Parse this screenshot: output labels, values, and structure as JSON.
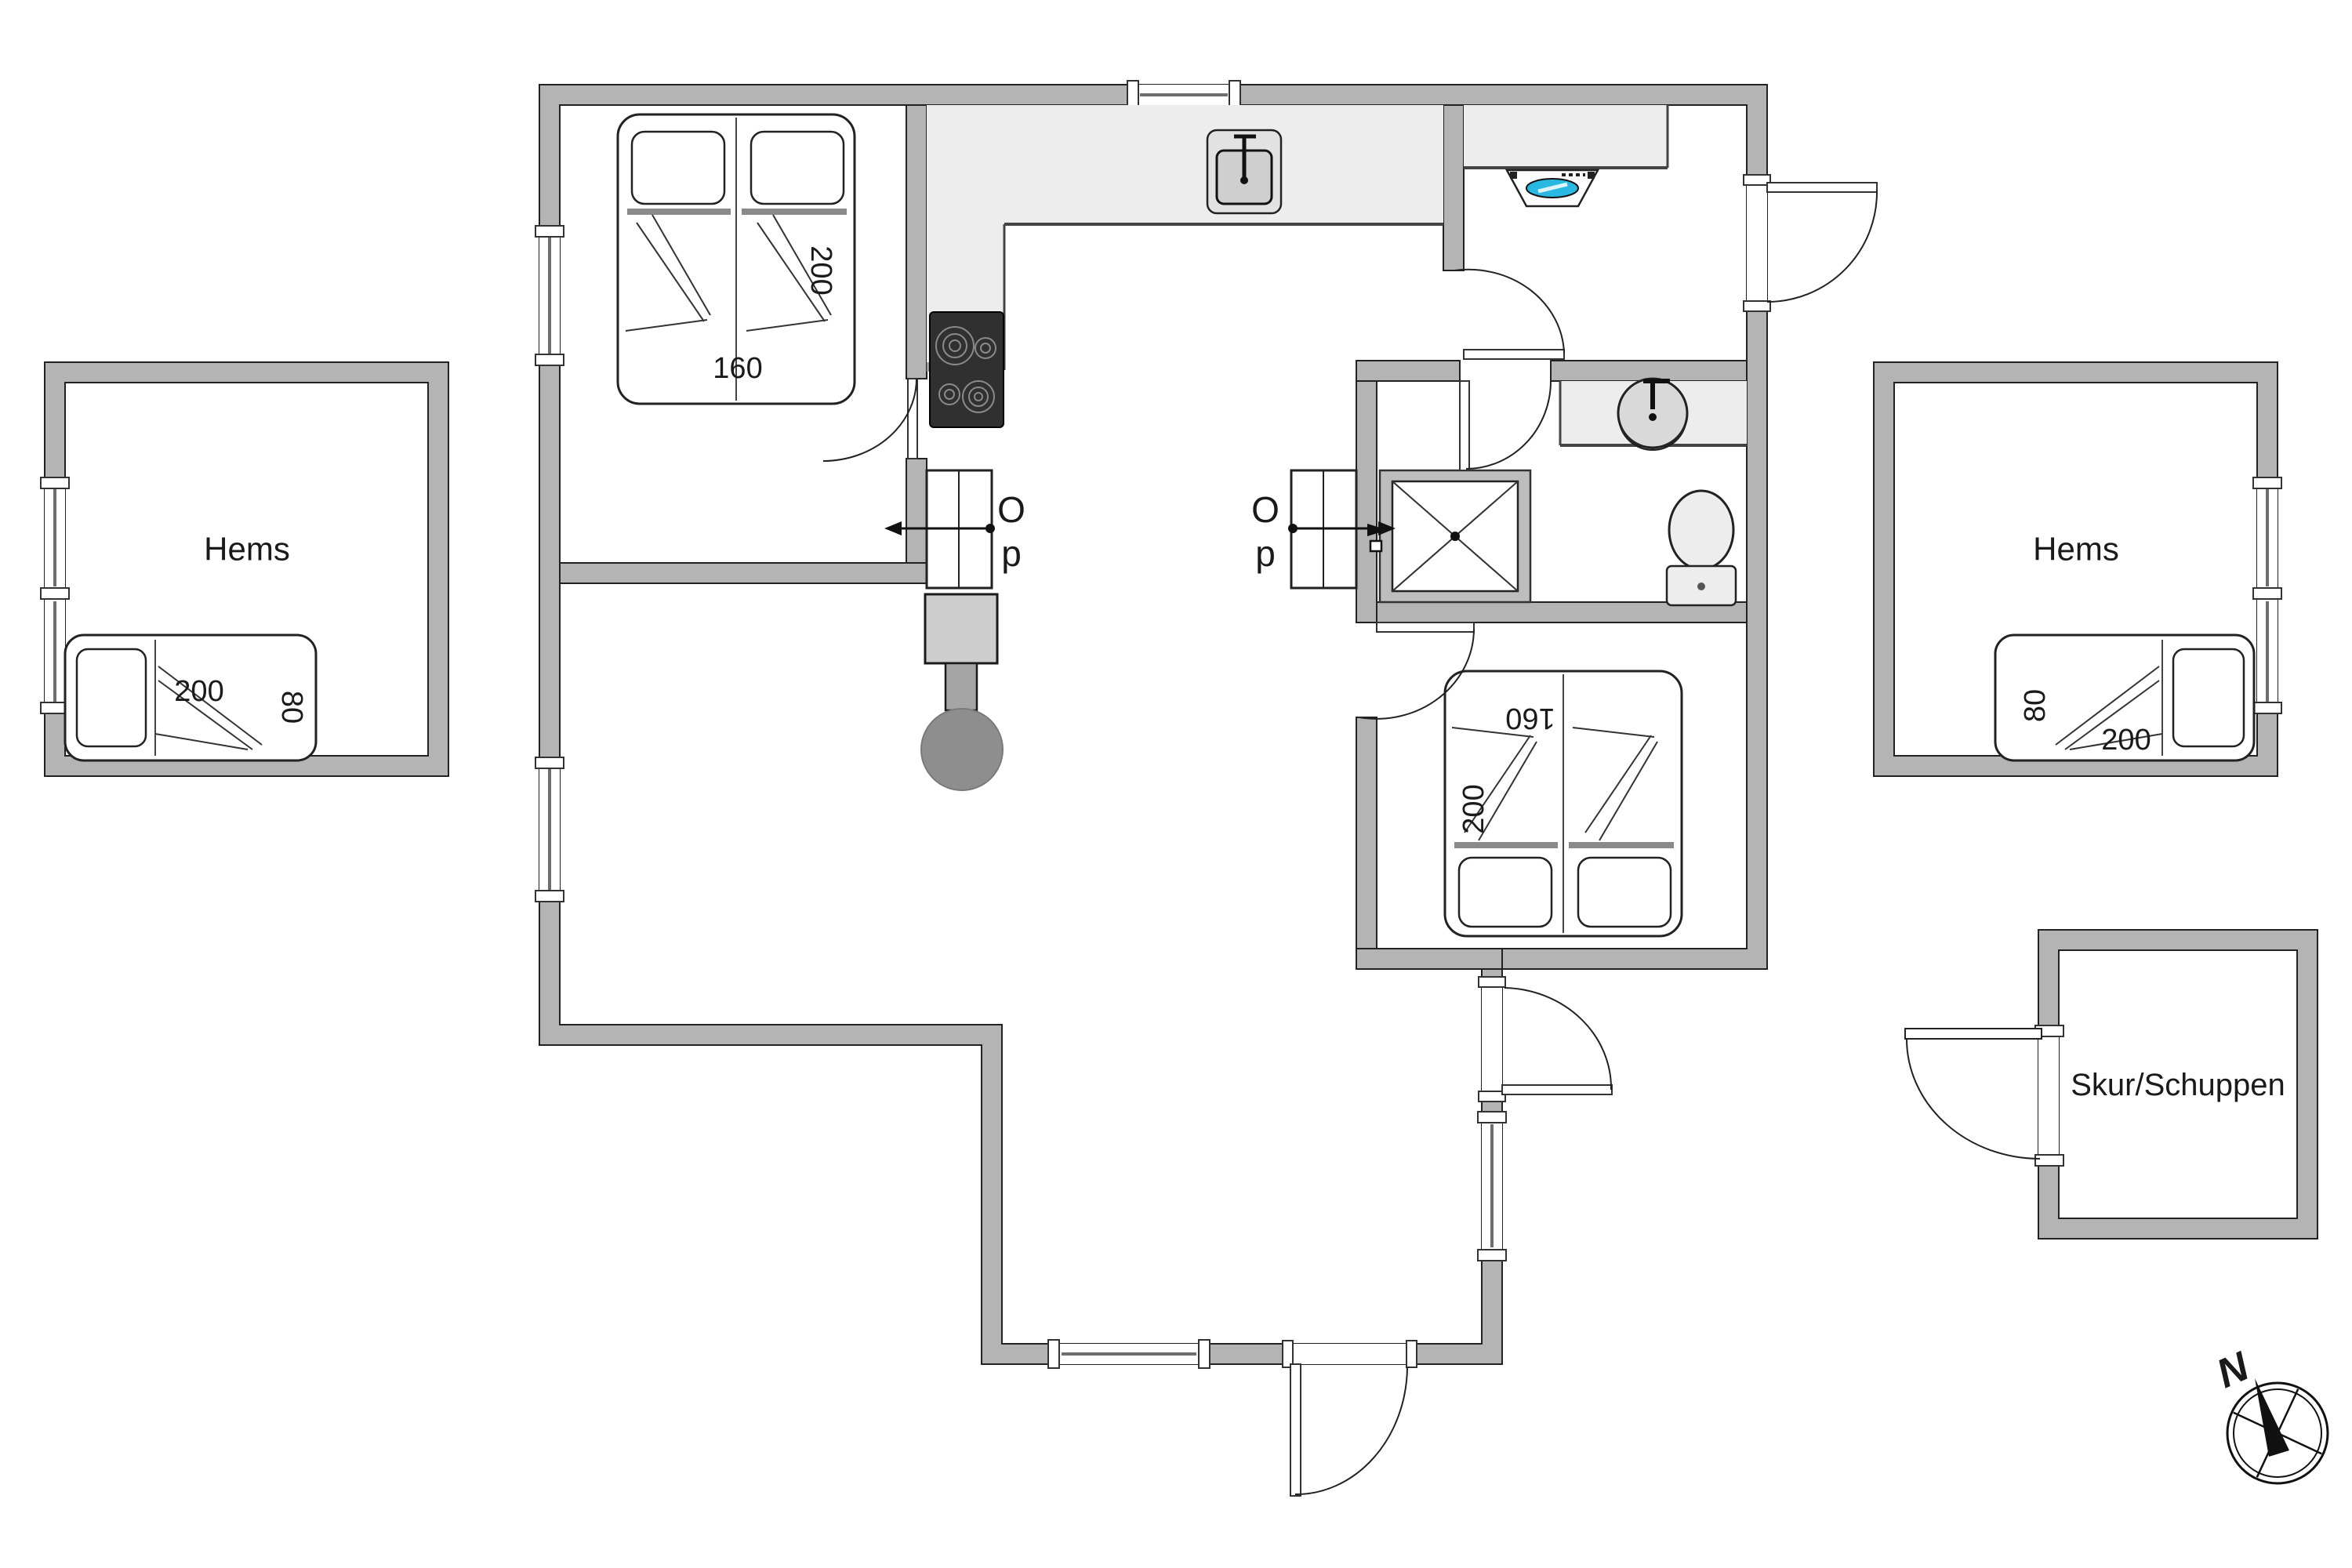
{
  "labels": {
    "hems_left": "Hems",
    "hems_right": "Hems",
    "shed": "Skur/Schuppen",
    "compass_north": "N",
    "stair_left_up_line1": "O",
    "stair_left_up_line2": "p",
    "stair_right_up_line1": "O",
    "stair_right_up_line2": "p"
  },
  "dimensions": {
    "bedroom1_bed_length": "200",
    "bedroom1_bed_width": "160",
    "bedroom2_bed_length": "200",
    "bedroom2_bed_width": "160",
    "hems_left_bed_length": "200",
    "hems_left_bed_width": "80",
    "hems_right_bed_length": "200",
    "hems_right_bed_width": "80"
  },
  "icons": {
    "kitchen_sink": "sink-icon",
    "stove": "cooktop-icon",
    "extractor": "extractor-fan-icon",
    "washbasin": "round-basin-icon",
    "shower": "shower-icon",
    "toilet": "toilet-icon",
    "wood_stove": "wood-stove-icon",
    "ladder": "ladder-icon",
    "compass": "compass-icon"
  },
  "colors": {
    "wall_fill": "#b4b4b4",
    "wall_line": "#222222",
    "counter_fill": "#ededed",
    "stove_fill": "#303030",
    "fireplace_fill": "#8e8e8e",
    "accent_blue": "#29b8e2",
    "background": "#ffffff"
  }
}
